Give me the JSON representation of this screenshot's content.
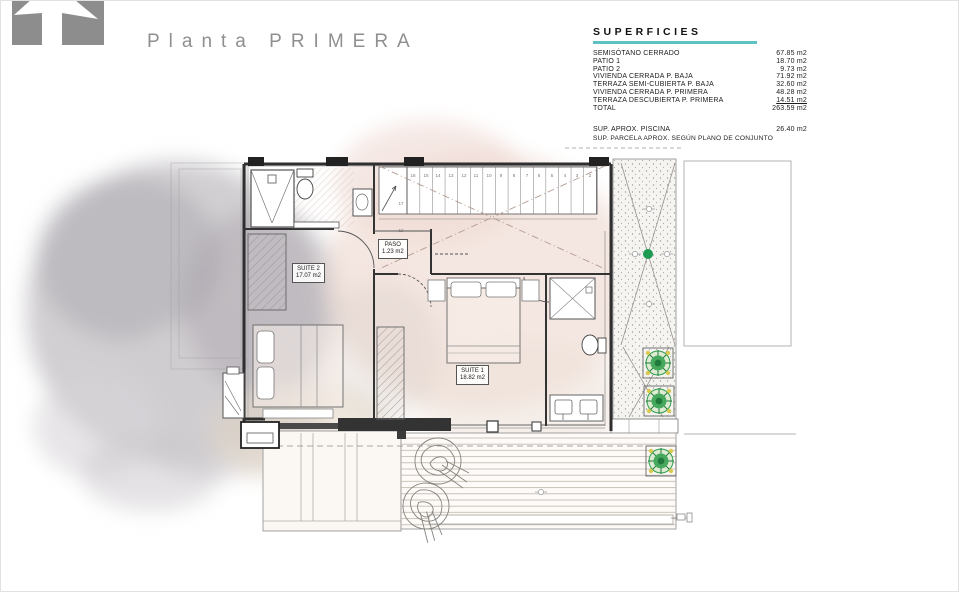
{
  "header": {
    "title": "Planta PRIMERA"
  },
  "surfaces": {
    "title": "SUPERFICIES",
    "accent_color": "#5fc2c2",
    "rows": [
      {
        "label": "SEMISÓTANO CERRADO",
        "value": "67.85 m2"
      },
      {
        "label": "PATIO  1",
        "value": "18.70 m2"
      },
      {
        "label": "PATIO 2",
        "value": "9.73 m2"
      },
      {
        "label": "VIVIENDA CERRADA P. BAJA",
        "value": "71.92 m2"
      },
      {
        "label": "TERRAZA SEMI-CUBIERTA P. BAJA",
        "value": "32.60 m2"
      },
      {
        "label": "VIVIENDA CERRADA P. PRIMERA",
        "value": "48.28 m2"
      },
      {
        "label": "TERRAZA DESCUBIERTA P. PRIMERA",
        "value": "14.51 m2"
      },
      {
        "label": "TOTAL",
        "value": "263.59 m2"
      }
    ],
    "pool_row": {
      "label": "SUP.  APROX.  PISCINA",
      "value": "26.40 m2"
    },
    "note": "SUP. PARCELA APROX. SEGÚN PLANO DE CONJUNTO"
  },
  "plan": {
    "rooms": [
      {
        "name": "SUITE 2",
        "area": "17.07 m2"
      },
      {
        "name": "PASO",
        "area": "1.23 m2"
      },
      {
        "name": "SUITE 1",
        "area": "18.82 m2"
      }
    ],
    "stair_numbers": [
      "16",
      "15",
      "14",
      "13",
      "12",
      "11",
      "10",
      "9",
      "8",
      "7",
      "6",
      "5",
      "4",
      "3",
      "2"
    ],
    "landing_numbers": [
      "17",
      "19"
    ],
    "colors": {
      "wall": "#2f2f2f",
      "thin_line": "#8a8a8a",
      "void_cross": "#b49c92",
      "wash_gray": "#c3c0c4",
      "wash_pink": "#eedcd3",
      "plant_green": "#2f9e4e",
      "dot_green": "#1d9b52",
      "accent_teal": "#5fc2c2"
    }
  }
}
